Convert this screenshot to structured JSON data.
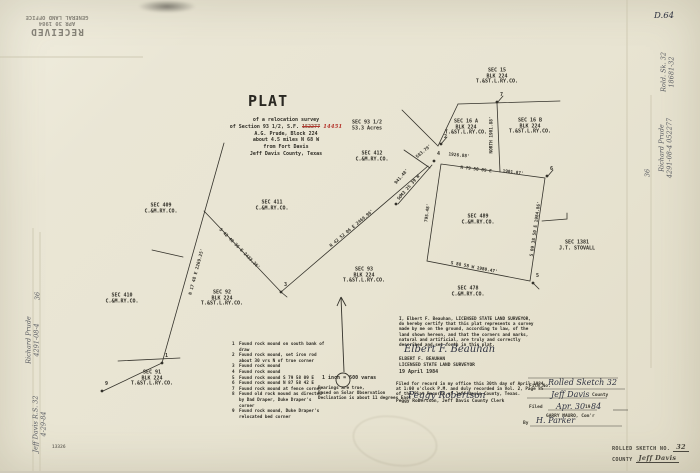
{
  "stamps": {
    "received": {
      "line1": "RECEIVED",
      "line2": "APR 30 1984",
      "line3": "GENERAL LAND OFFICE"
    },
    "rolled_sketch": {
      "label": "ROLLED SKETCH NO.",
      "number": "32",
      "county_label": "COUNTY",
      "county_value": "Jeff Davis"
    }
  },
  "corner_mark": "D.64",
  "small_number": "13326",
  "title": "PLAT",
  "description": {
    "l1": "of a relocation survey",
    "l2_prefix": "of Section 93 1/2, S.F. ",
    "l2_struck": "152277",
    "l2_red": "14451",
    "l3": "A.G. Prude, Block 224",
    "l4": "about 4.5 miles N 68 W",
    "l5": "from Fort Davis",
    "l6": "Jeff Davis County, Texas"
  },
  "map": {
    "sections": [
      {
        "x": 497,
        "y": 77,
        "lines": [
          "SEC 15",
          "BLK 224",
          "T.&ST.L.RY.CO."
        ]
      },
      {
        "x": 466,
        "y": 128,
        "lines": [
          "SEC 16 A",
          "BLK 224",
          "T.&ST.L.RY.CO."
        ]
      },
      {
        "x": 530,
        "y": 127,
        "lines": [
          "SEC 16 B",
          "BLK 224",
          "T.&ST.L.RY.CO."
        ]
      },
      {
        "x": 367,
        "y": 126,
        "lines": [
          "SEC 93 1/2",
          "53.3 Acres"
        ]
      },
      {
        "x": 372,
        "y": 157,
        "lines": [
          "SEC 412",
          "C.&M.RY.CO."
        ]
      },
      {
        "x": 161,
        "y": 209,
        "lines": [
          "SEC 409",
          "C.&M.RY.CO."
        ]
      },
      {
        "x": 272,
        "y": 206,
        "lines": [
          "SEC 411",
          "C.&M.RY.CO."
        ]
      },
      {
        "x": 122,
        "y": 299,
        "lines": [
          "SEC 410",
          "C.&M.RY.CO."
        ]
      },
      {
        "x": 222,
        "y": 299,
        "lines": [
          "SEC 92",
          "BLK 224",
          "T.&ST.L.RY.CO."
        ]
      },
      {
        "x": 364,
        "y": 276,
        "lines": [
          "SEC 93",
          "BLK 224",
          "T.&ST.L.RY.CO."
        ]
      },
      {
        "x": 478,
        "y": 220,
        "lines": [
          "SEC 489",
          "C.&M.RY.CO."
        ]
      },
      {
        "x": 468,
        "y": 292,
        "lines": [
          "SEC 478",
          "C.&M.RY.CO."
        ]
      },
      {
        "x": 577,
        "y": 246,
        "lines": [
          "SEC 1381",
          "J.T. STOVALL"
        ]
      },
      {
        "x": 152,
        "y": 379,
        "lines": [
          "SEC 91",
          "BLK 224",
          "T.&ST.L.RY.CO."
        ]
      }
    ],
    "bearings": [
      {
        "x": 197,
        "y": 272,
        "rot": -75,
        "text": "N 17 48 E  2269.25'"
      },
      {
        "x": 239,
        "y": 249,
        "rot": 45,
        "text": "S 42 48 36 E  2423.36'"
      },
      {
        "x": 352,
        "y": 229,
        "rot": -40,
        "text": "N 42 52 06 E  2469.96'"
      },
      {
        "x": 492,
        "y": 135,
        "rot": -90,
        "text": "NORTH  1901.88'"
      },
      {
        "x": 459,
        "y": 156,
        "rot": 6,
        "text": "1926.88'"
      },
      {
        "x": 476,
        "y": 170,
        "rot": 7,
        "text": "N 79 50 09 E"
      },
      {
        "x": 513,
        "y": 173,
        "rot": 7,
        "text": "1901.87'"
      },
      {
        "x": 536,
        "y": 229,
        "rot": -82,
        "text": "S 09 38 50 E  1984.86'"
      },
      {
        "x": 474,
        "y": 268,
        "rot": 11,
        "text": "S 88 58 W  1980.47'"
      },
      {
        "x": 428,
        "y": 213,
        "rot": -82,
        "text": "795.48'"
      },
      {
        "x": 409,
        "y": 188,
        "rot": -49,
        "text": "S 43 25 39 W"
      },
      {
        "x": 402,
        "y": 177,
        "rot": -49,
        "text": "941.48'"
      },
      {
        "x": 424,
        "y": 152,
        "rot": -40,
        "text": "583.79'"
      }
    ],
    "corners": [
      {
        "n": "1",
        "x": 162,
        "y": 363
      },
      {
        "n": "2",
        "x": 441,
        "y": 144
      },
      {
        "n": "3",
        "x": 281,
        "y": 292
      },
      {
        "n": "4",
        "x": 434,
        "y": 161
      },
      {
        "n": "5",
        "x": 533,
        "y": 283
      },
      {
        "n": "6",
        "x": 547,
        "y": 176
      },
      {
        "n": "7",
        "x": 497,
        "y": 102
      },
      {
        "n": "8",
        "x": 396,
        "y": 204
      },
      {
        "n": "9",
        "x": 102,
        "y": 391
      }
    ]
  },
  "legend": {
    "items": [
      {
        "n": "1",
        "text": "Found rock mound on south bank of draw"
      },
      {
        "n": "2",
        "text": "Found rock mound, set iron rod about 30 vrs N of true corner"
      },
      {
        "n": "3",
        "text": "Found rock mound"
      },
      {
        "n": "4",
        "text": "Found rock mound"
      },
      {
        "n": "5",
        "text": "Found rock mound  S 79 58 09 E"
      },
      {
        "n": "6",
        "text": "Found rock mound  N 87 58 42 E"
      },
      {
        "n": "7",
        "text": "Found rock mound at fence corner"
      },
      {
        "n": "8",
        "text": "Found old rock mound as directed by Dad Draper, Duke Draper's corner"
      },
      {
        "n": "9",
        "text": "Found rock mound, Duke Draper's relocated bed corner"
      }
    ]
  },
  "notes": {
    "scale": "1 inch = 500 varas",
    "bearing_lines": [
      "Bearings are true,",
      "Based on Solar Observation",
      "Declination is about 11 degrees East"
    ]
  },
  "certification": {
    "lines": [
      "I, Elbert F. Beauhan, LICENSED STATE LAND SURVEYOR,",
      "do hereby certify that this plat represents a survey",
      "made by me on the ground, according to law, of the",
      "land shown hereon, and that the corners and marks,",
      "natural and artificial, are truly and correctly",
      "described and set forth in this plat."
    ],
    "signature": "Elbert F. Beauhan",
    "name_line": "ELBERT F. BEAUHAN",
    "title_line": "LICENSED STATE LAND SURVEYOR",
    "date": "19 April 1984"
  },
  "filing": {
    "lines": [
      "Filed for record in my office this 30th day of April 1984",
      "at 1:00 o'clock P.M. and duly recorded in Vol. 2, Page 85",
      "of the Plat Records of Jeff Davis County, Texas."
    ],
    "signature": "Peggy Robertson",
    "clerk_line": "Peggy Robertson, Jeff Davis County Clerk"
  },
  "form": {
    "file_no_label": "File No.",
    "file_no_value": "Rolled Sketch 32",
    "county_value": "Jeff Davis",
    "county_label": "County",
    "filed_label": "Filed",
    "filed_value": "Apr. 30",
    "year_prefix": "19",
    "year_value": "84",
    "commissioner": "GARRY MAURO, Com'r",
    "by_label": "By",
    "by_value": "H. Parker"
  },
  "margin_notes": {
    "items": [
      {
        "x": 668,
        "y": 72,
        "rot": -90,
        "lines": [
          "Rold. Sk. 32",
          "18681-32"
        ]
      },
      {
        "x": 666,
        "y": 148,
        "rot": -90,
        "lines": [
          "Richard Prude",
          "4291-08-4  052277"
        ]
      },
      {
        "x": 648,
        "y": 173,
        "rot": -90,
        "lines": [
          "36"
        ]
      },
      {
        "x": 38,
        "y": 296,
        "rot": -90,
        "lines": [
          "36"
        ]
      },
      {
        "x": 33,
        "y": 340,
        "rot": -90,
        "lines": [
          "Richard Prude",
          "4291-08-4"
        ]
      },
      {
        "x": 40,
        "y": 424,
        "rot": -90,
        "lines": [
          "Jeff Davis  R.S. 32",
          "4-29-84"
        ]
      }
    ]
  },
  "colors": {
    "ink": "#34322b",
    "red": "#b5372e",
    "paper": "#e8e4d2"
  }
}
